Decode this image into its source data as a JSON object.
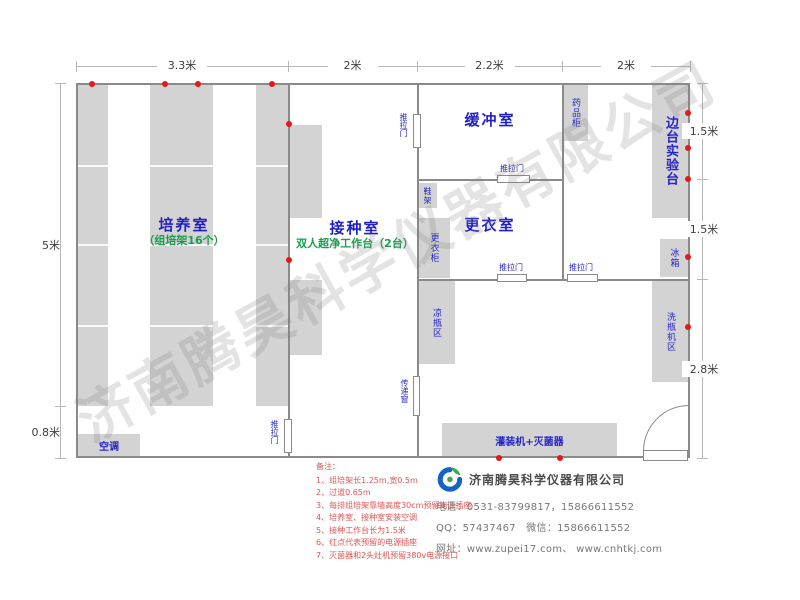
{
  "watermark": "济南腾昊科学仪器有限公司",
  "colors": {
    "fill": "#d3d3d3",
    "wall": "#8a8a8a",
    "dim_line": "#b8b8b8",
    "room_label": "#1f1fc8",
    "sub_label": "#189e4e",
    "equip_label": "#2525c8",
    "dim_text": "#3d3d3d",
    "outlet": "#e81717",
    "note_text": "#e05555"
  },
  "plan": {
    "walls": [
      [
        76,
        83,
        614,
        2
      ],
      [
        76,
        456,
        569,
        2
      ],
      [
        76,
        83,
        2,
        375
      ],
      [
        688,
        83,
        2,
        375
      ],
      [
        288,
        83,
        2,
        337
      ],
      [
        288,
        452,
        2,
        6
      ],
      [
        417,
        83,
        2,
        32
      ],
      [
        417,
        147,
        2,
        230
      ],
      [
        417,
        415,
        2,
        43
      ],
      [
        562,
        83,
        2,
        198
      ],
      [
        417,
        179,
        80,
        2
      ],
      [
        530,
        179,
        34,
        2
      ],
      [
        417,
        279,
        80,
        2
      ],
      [
        527,
        279,
        40,
        2
      ],
      [
        598,
        279,
        92,
        2
      ]
    ],
    "equipment": [
      {
        "name": "culture-rack-1",
        "x": 76,
        "y": 84,
        "w": 32,
        "h": 322,
        "dividers": [
          165,
          244,
          325
        ]
      },
      {
        "name": "culture-rack-2",
        "x": 150,
        "y": 84,
        "w": 63,
        "h": 322,
        "dividers": [
          165,
          244,
          325
        ]
      },
      {
        "name": "culture-rack-3",
        "x": 256,
        "y": 84,
        "w": 32,
        "h": 322,
        "dividers": [
          165,
          244,
          325
        ]
      },
      {
        "name": "clean-bench-1",
        "x": 290,
        "y": 125,
        "w": 32,
        "h": 93
      },
      {
        "name": "clean-bench-2",
        "x": 290,
        "y": 280,
        "w": 32,
        "h": 75
      },
      {
        "name": "air-conditioner",
        "label": "空调",
        "x": 78,
        "y": 434,
        "w": 62,
        "h": 23,
        "fs": 10,
        "bold": true
      },
      {
        "name": "medicine-cabinet",
        "label": "药品柜",
        "x": 563,
        "y": 84,
        "w": 25,
        "h": 57,
        "v": true,
        "fs": 9
      },
      {
        "name": "side-lab-bench",
        "label": "边台实验台",
        "x": 652,
        "y": 84,
        "w": 37,
        "h": 134,
        "v": true,
        "fs": 13,
        "bold": true
      },
      {
        "name": "fridge",
        "label": "冰箱",
        "x": 660,
        "y": 239,
        "w": 28,
        "h": 38,
        "v": true,
        "fs": 9
      },
      {
        "name": "bottle-washing-area",
        "label": "洗瓶机区",
        "x": 652,
        "y": 281,
        "w": 37,
        "h": 101,
        "v": true,
        "fs": 9
      },
      {
        "name": "shoe-rack",
        "label": "鞋架",
        "x": 418,
        "y": 183,
        "w": 19,
        "h": 25,
        "v": true,
        "fs": 8
      },
      {
        "name": "wardrobe",
        "label": "更衣柜",
        "x": 418,
        "y": 218,
        "w": 32,
        "h": 60,
        "v": true,
        "fs": 9
      },
      {
        "name": "bottle-cooling-area",
        "label": "凉瓶区",
        "x": 418,
        "y": 281,
        "w": 37,
        "h": 83,
        "v": true,
        "fs": 9
      },
      {
        "name": "filling-machine-sterilizer",
        "label": "灌装机+灭菌器",
        "x": 442,
        "y": 423,
        "w": 175,
        "h": 34,
        "fs": 10,
        "bold": true
      }
    ],
    "doors": [
      {
        "name": "sliding-door-inoculation-buffer",
        "label": "推拉门",
        "x": 413,
        "y": 114,
        "w": 8,
        "h": 34,
        "v": true,
        "lx": 399,
        "ly": 113
      },
      {
        "name": "sliding-door-culture-inoculation",
        "label": "推拉门",
        "x": 284,
        "y": 419,
        "w": 8,
        "h": 34,
        "v": true,
        "lx": 270,
        "ly": 420
      },
      {
        "name": "pass-through-window",
        "label": "传递窗",
        "x": 413,
        "y": 376,
        "w": 7,
        "h": 40,
        "v": true,
        "lx": 400,
        "ly": 379
      },
      {
        "name": "sliding-door-buffer",
        "label": "推拉门",
        "x": 497,
        "y": 175,
        "w": 33,
        "h": 8,
        "lx": 500,
        "ly": 164
      },
      {
        "name": "sliding-door-dressing-1",
        "label": "推拉门",
        "x": 497,
        "y": 274,
        "w": 30,
        "h": 8,
        "lx": 499,
        "ly": 263
      },
      {
        "name": "sliding-door-dressing-2",
        "label": "推拉门",
        "x": 567,
        "y": 274,
        "w": 31,
        "h": 8,
        "lx": 569,
        "ly": 263
      }
    ],
    "swing_door": {
      "leaf": [
        643,
        450,
        45,
        11
      ],
      "arc": [
        643,
        405,
        45,
        45
      ]
    },
    "outlets": [
      [
        92,
        84
      ],
      [
        165,
        84
      ],
      [
        198,
        84
      ],
      [
        272,
        84
      ],
      [
        289,
        124
      ],
      [
        289,
        260
      ],
      [
        688,
        113
      ],
      [
        688,
        148
      ],
      [
        688,
        179
      ],
      [
        688,
        257
      ],
      [
        688,
        327
      ],
      [
        499,
        458
      ],
      [
        560,
        458
      ]
    ],
    "rooms": [
      {
        "name": "culture-room",
        "label": "培养室",
        "sub": "（组培架16个）",
        "cx": 184,
        "cy": 224
      },
      {
        "name": "inoculation-room",
        "label": "接种室",
        "sub": "双人超净工作台（2台）",
        "cx": 355,
        "cy": 227
      },
      {
        "name": "buffer-room",
        "label": "缓冲室",
        "cx": 490,
        "cy": 119
      },
      {
        "name": "dressing-room",
        "label": "更衣室",
        "cx": 490,
        "cy": 224
      }
    ],
    "dims": {
      "top": {
        "pos": 66,
        "ticks": [
          76,
          288,
          417,
          562,
          690
        ],
        "labels": [
          "3.3米",
          "2米",
          "2.2米",
          "2米"
        ]
      },
      "left": {
        "pos": 60,
        "ticks": [
          83,
          406,
          458
        ],
        "labels": [
          "5米",
          "0.8米"
        ]
      },
      "right": {
        "pos": 702,
        "ticks": [
          83,
          179,
          279,
          458
        ],
        "labels": [
          "1.5米",
          "1.5米",
          "2.8米"
        ]
      }
    }
  },
  "notes": {
    "title": "备注：",
    "items": [
      "1、组培架长1.25m,宽0.5m",
      "2、过道0.65m",
      "3、每排组培架靠墙高度30cm预留电源插座",
      "4、培养室、接种室安装空调",
      "5、接种工作台长为1.5米",
      "6、红点代表预留的电源插座",
      "7、灭菌器和2头灶机预留380v电源接口"
    ]
  },
  "company": {
    "name": "济南腾昊科学仪器有限公司",
    "phone": "电话：0531-83799817，15866611552",
    "qq_wechat": "QQ：57437467　微信：15866611552",
    "website": "网址：www.zupei17.com、 www.cnhtkj.com"
  }
}
